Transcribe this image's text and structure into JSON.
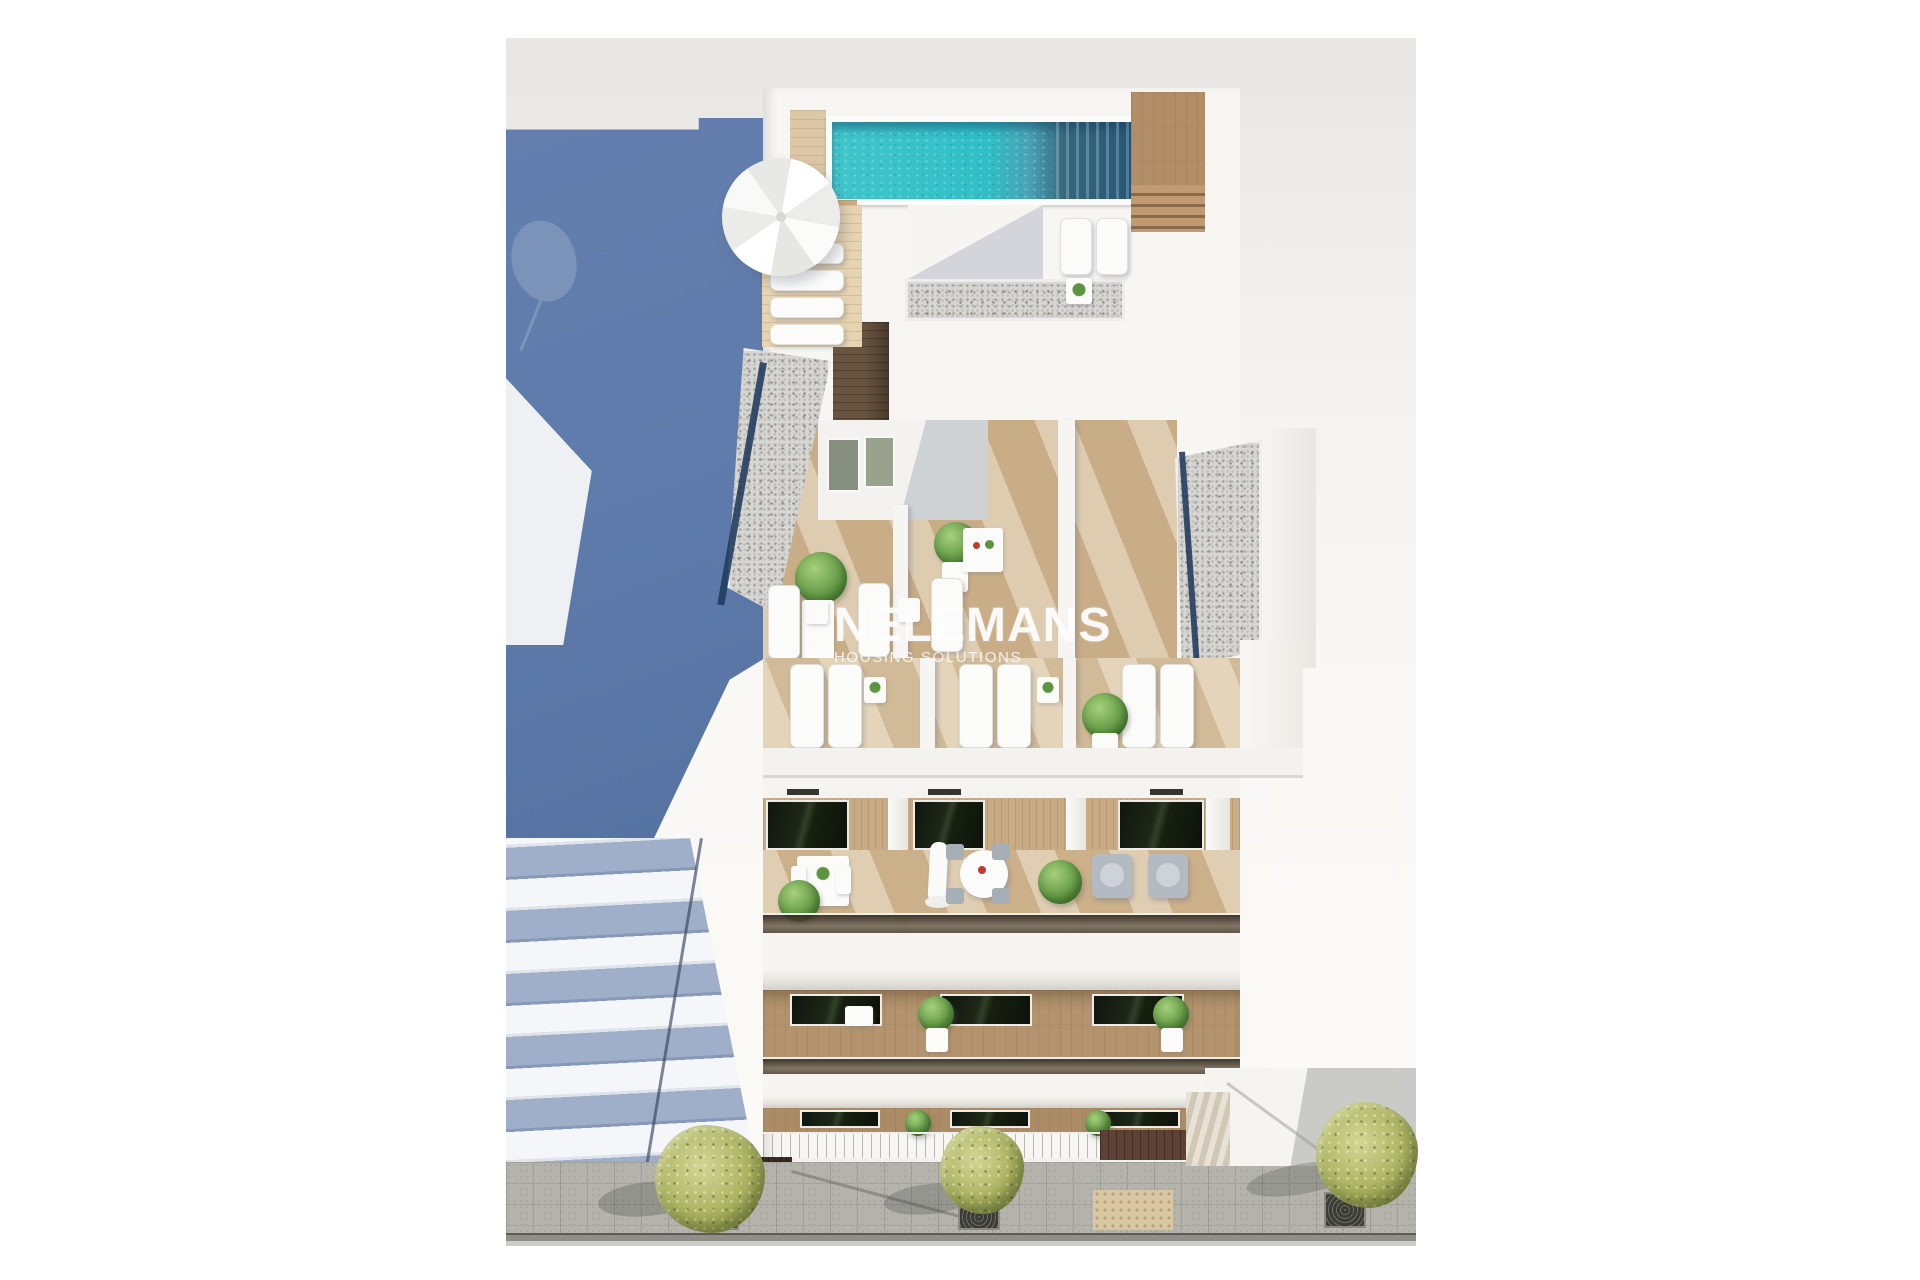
{
  "watermark": {
    "brand": "NELEMANS",
    "tagline": "HOUSING SOLUTIONS"
  },
  "scene": {
    "type": "3d-architectural-render",
    "view": "aerial-top-down",
    "subject": "white residential apartment building with rooftop pool, wooden terraces and street frontage",
    "objects": [
      "rooftop swimming pool",
      "sun parasol",
      "sun loungers",
      "wooden roof terraces",
      "gravel flat roofs",
      "glass balustraded balconies",
      "potted plants",
      "round terrace tables",
      "street trees with grates",
      "paved sidewalk",
      "tactile paving",
      "entrance platform with steps",
      "shaded neighbouring building wall",
      "neighbouring building balcony slabs"
    ]
  },
  "colors": {
    "background": "#fbfaf7",
    "sky": "#e9e7e3",
    "shaded_wall_blue": "#5e7bab",
    "slab_shadow_blue": "#9fafc9",
    "pool_turquoise": "#35c2c8",
    "pool_deep": "#2c6486",
    "wood_light": "#cdb694",
    "wood_mid": "#c8ab84",
    "wood_dark": "#6a543f",
    "gravel": "#d7d6d3",
    "glass_tint": "#47392c",
    "foliage": "#5d9440",
    "street_foliage": "#aab25e",
    "pavement": "#b4b4ad",
    "tactile": "#d9c7a3",
    "building_white": "#f7f6f2"
  }
}
